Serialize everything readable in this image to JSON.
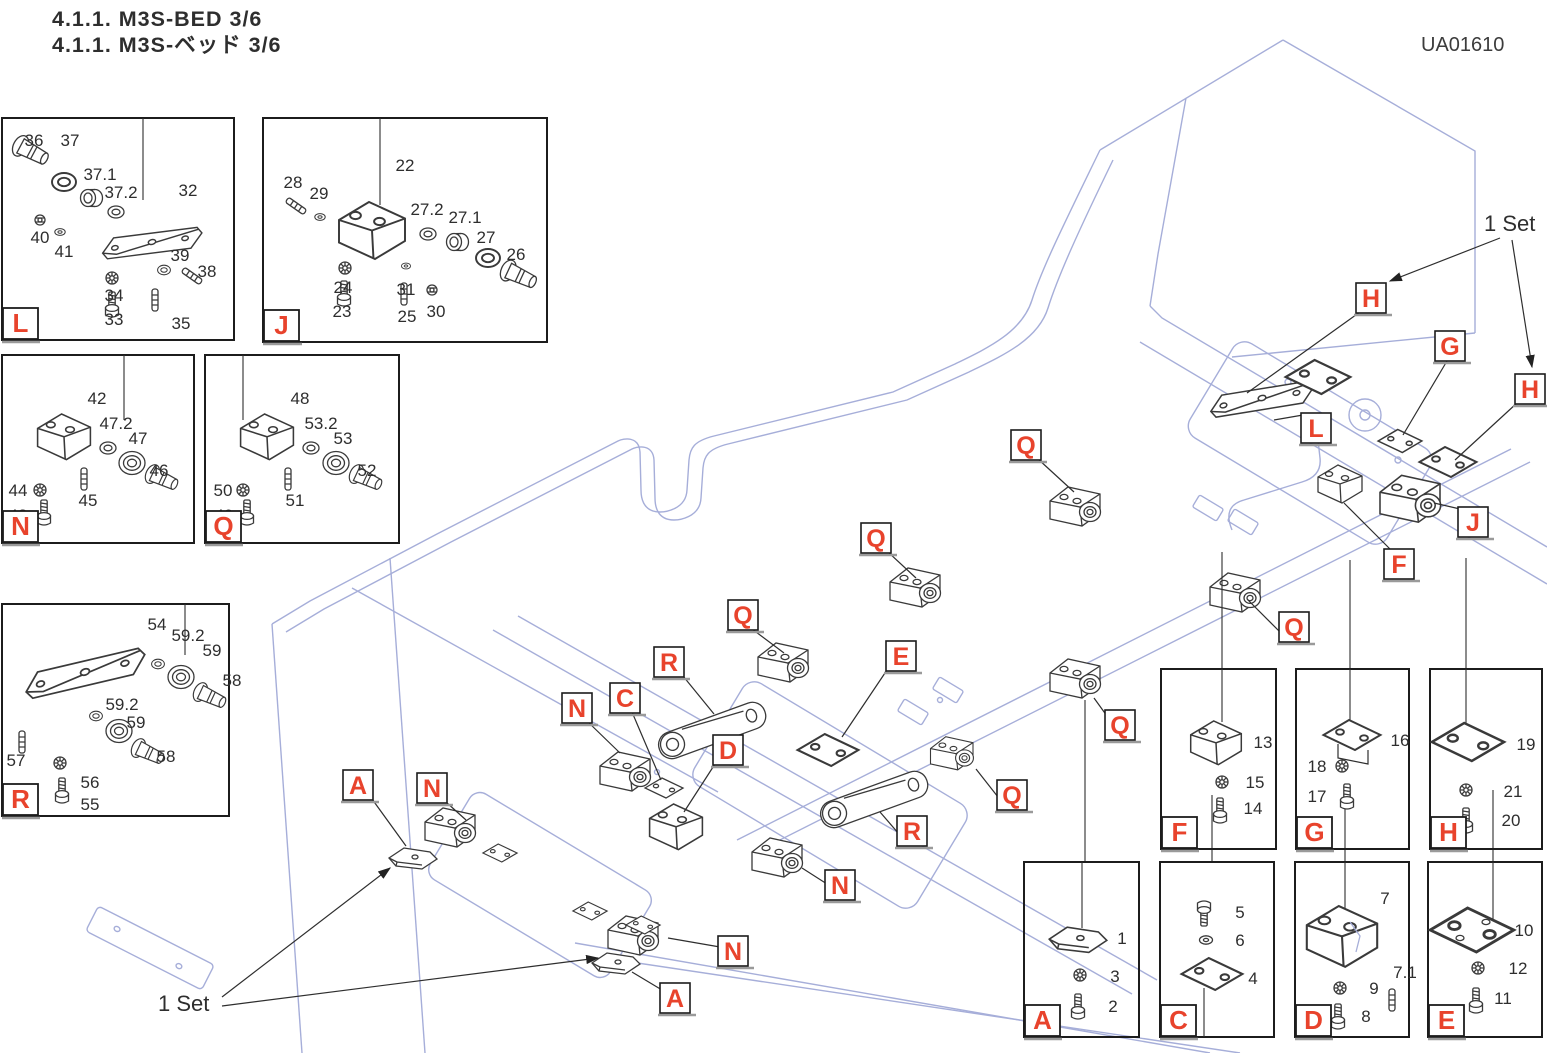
{
  "header": {
    "section_title_en": "4.1.1. M3S-BED 3/6",
    "section_title_jp": "4.1.1. M3S-ベッド 3/6",
    "drawing_no": "UA01610"
  },
  "annotations": {
    "set_top": "1 Set",
    "set_bottom": "1 Set"
  },
  "colors": {
    "accent_red": "#e8432c",
    "frame_blue": "#a6aed9",
    "line_dark": "#2e2e2e"
  },
  "main_labels": [
    "H",
    "G",
    "H",
    "L",
    "J",
    "F",
    "Q",
    "Q",
    "Q",
    "Q",
    "Q",
    "Q",
    "R",
    "E",
    "N",
    "C",
    "D",
    "A",
    "N",
    "R",
    "N",
    "N",
    "A"
  ],
  "detail_boxes": [
    {
      "letter": "L",
      "callouts": [
        "36",
        "37",
        "37.1",
        "37.2",
        "32",
        "40",
        "41",
        "39",
        "38",
        "34",
        "33",
        "35"
      ]
    },
    {
      "letter": "J",
      "callouts": [
        "28",
        "29",
        "22",
        "27.2",
        "27.1",
        "27",
        "26",
        "24",
        "23",
        "31",
        "25",
        "30"
      ]
    },
    {
      "letter": "N",
      "callouts": [
        "42",
        "47.2",
        "47",
        "46",
        "44",
        "45",
        "43"
      ]
    },
    {
      "letter": "Q",
      "callouts": [
        "48",
        "53.2",
        "53",
        "52",
        "50",
        "51",
        "49"
      ]
    },
    {
      "letter": "R",
      "callouts": [
        "54",
        "59.2",
        "59",
        "58",
        "59.2",
        "59",
        "58",
        "57",
        "56",
        "55"
      ]
    },
    {
      "letter": "F",
      "callouts": [
        "13",
        "15",
        "14"
      ]
    },
    {
      "letter": "G",
      "callouts": [
        "16",
        "18",
        "17"
      ]
    },
    {
      "letter": "H",
      "callouts": [
        "19",
        "21",
        "20"
      ]
    },
    {
      "letter": "A",
      "callouts": [
        "1",
        "3",
        "2"
      ]
    },
    {
      "letter": "C",
      "callouts": [
        "5",
        "6",
        "4"
      ]
    },
    {
      "letter": "D",
      "callouts": [
        "7",
        "9",
        "7.1",
        "8"
      ]
    },
    {
      "letter": "E",
      "callouts": [
        "10",
        "12",
        "11"
      ]
    }
  ]
}
